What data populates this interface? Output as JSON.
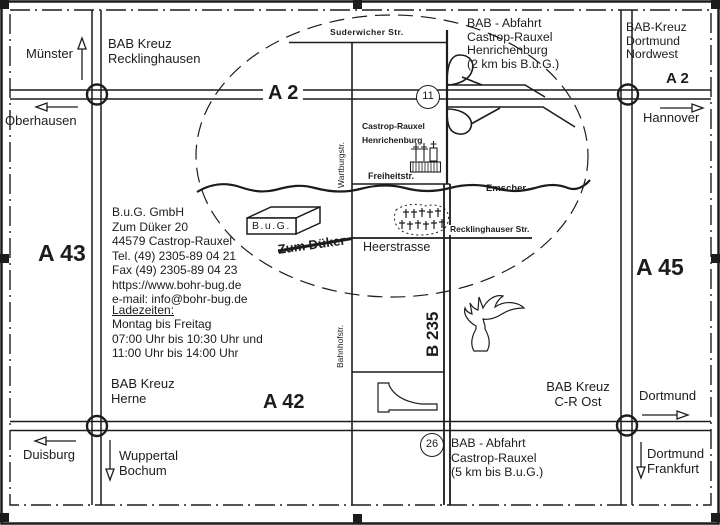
{
  "map": {
    "highways": {
      "a2_left": "A 2",
      "a2_right": "A 2",
      "a42": "A 42",
      "a43": "A 43",
      "a45": "A 45",
      "b235": "B 235"
    },
    "junctions": {
      "north_number": "11",
      "south_number": "26"
    },
    "interchanges": {
      "recklinghausen": "BAB Kreuz\nRecklinghausen",
      "dortmund_nordwest": "BAB-Kreuz\nDortmund\nNordwest",
      "herne": "BAB Kreuz\nHerne",
      "cr_ost": "BAB Kreuz\nC-R Ost"
    },
    "exits": {
      "north": "BAB - Abfahrt\nCastrop-Rauxel\nHenrichenburg\n(2 km bis B.u.G.)",
      "south": "BAB - Abfahrt\nCastrop-Rauxel\n(5 km bis B.u.G.)"
    },
    "destinations": {
      "muenster": "Münster",
      "oberhausen": "Oberhausen",
      "hannover": "Hannover",
      "duisburg": "Duisburg",
      "wuppertal_bochum": "Wuppertal\nBochum",
      "dortmund": "Dortmund",
      "dortmund_frankfurt": "Dortmund\nFrankfurt"
    },
    "streets": {
      "suderwicher": "Suderwicher Str.",
      "wartburg": "Wartburgstr.",
      "freiheit": "Freiheitstr.",
      "bahnhof": "Bahnhofstr.",
      "heer": "Heerstrasse",
      "recklinghauser": "Recklinghauser Str.",
      "zum_dueker": "Zum Düker"
    },
    "river": "Emscher",
    "place": "Castrop-Rauxel\nHenrichenburg",
    "company_marker": "B.u.G."
  },
  "info": {
    "address": "B.u.G. GmbH\nZum Düker 20\n44579 Castrop-Rauxel\nTel. (49) 2305-89 04 21\nFax (49) 2305-89 04 23\nhttps://www.bohr-bug.de\ne-mail: info@bohr-bug.de",
    "hours_title": "Ladezeiten:",
    "hours": "Montag bis Freitag\n07:00 Uhr bis 10:30 Uhr und\n11:00 Uhr bis 14:00 Uhr"
  },
  "colors": {
    "ink": "#1c1c1c",
    "paper": "#ffffff"
  }
}
